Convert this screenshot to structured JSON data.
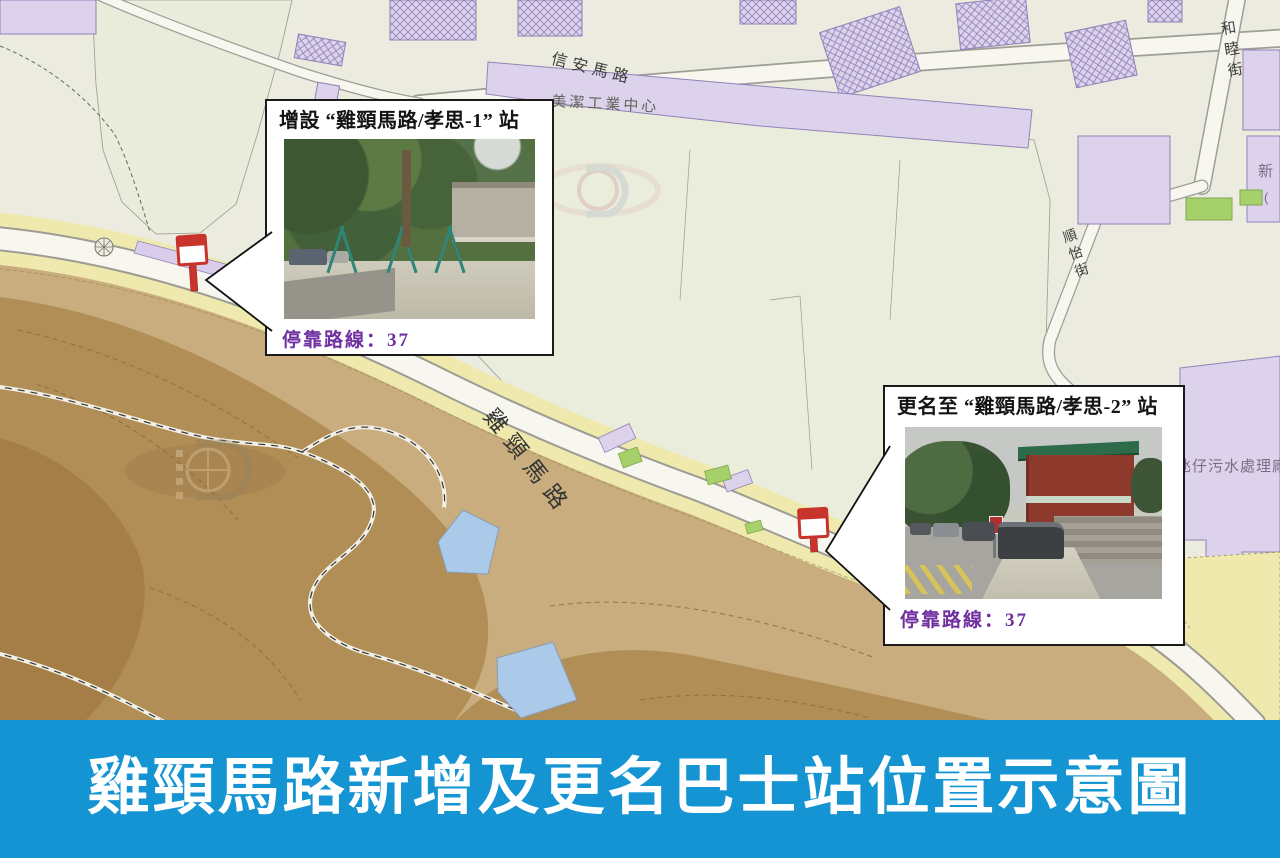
{
  "banner": {
    "title": "雞頸馬路新增及更名巴士站位置示意圖"
  },
  "callouts": [
    {
      "title": "增設 “雞頸馬路/孝思-1” 站",
      "routes": "停靠路線：37"
    },
    {
      "title": "更名至 “雞頸馬路/孝思-2” 站",
      "routes": "停靠路線：37"
    }
  ],
  "map": {
    "labels": {
      "son_on_road": "信安馬路",
      "mei_kit_industrial_centre": "美潔工業中心",
      "wo_mut_street": "和睦街",
      "son_yi_street": "順怡街",
      "kai_keng_road": "雞頸馬路",
      "taipa_sewage_plant": "氹仔污水處理廠",
      "edge_partial_1": "新",
      "edge_partial_2": "("
    },
    "icons": {
      "bus_stop": "bus-stop-sign-icon",
      "watermark": "cartography-logo-watermark",
      "roundabout": "roundabout-rosette-icon"
    }
  },
  "colors": {
    "banner_bg": "#1494D2",
    "banner_text": "#FFFFFF",
    "callout_border": "#1A1A1A",
    "routes_text": "#7030A0",
    "bus_stop_red": "#C8342B",
    "map_bg": "#EBECDF",
    "building_lavender": "#DCD2EC",
    "sand": "#EFE9AD",
    "hill_brown": "#B28E57",
    "pond_blue": "#ABC9E9",
    "green_area": "#A6D16A"
  }
}
